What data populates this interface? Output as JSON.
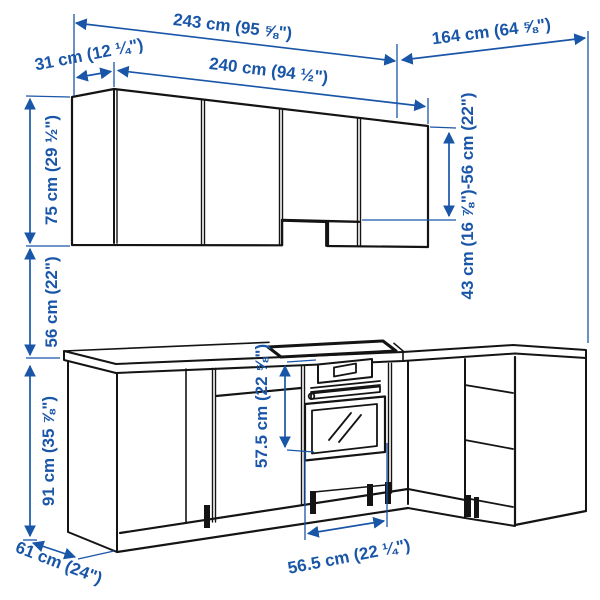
{
  "diagram": {
    "type": "kitchen-corner-dimension-drawing",
    "background": "#ffffff"
  },
  "colors": {
    "dimension_blue": "#1a56a8",
    "line_black": "#141414"
  },
  "dimensions": {
    "total_width": "243 cm (95 ⅝\")",
    "right_run_width": "164 cm (64 ⅝\")",
    "wall_side_depth": "31 cm (12 ¼\")",
    "wall_front_width": "240 cm (94 ½\")",
    "wall_cabinet_height": "75 cm (29 ½\")",
    "wall_cabinet_right_height": "43 cm (16 ⅞\")-56 cm (22\")",
    "backsplash_height": "56 cm (22\")",
    "base_cabinet_height": "91 cm (35 ⅞\")",
    "oven_height": "57.5 cm (22 ⅝\")",
    "oven_width": "56.5 cm (22 ¼\")",
    "counter_depth": "61 cm (24\")"
  }
}
